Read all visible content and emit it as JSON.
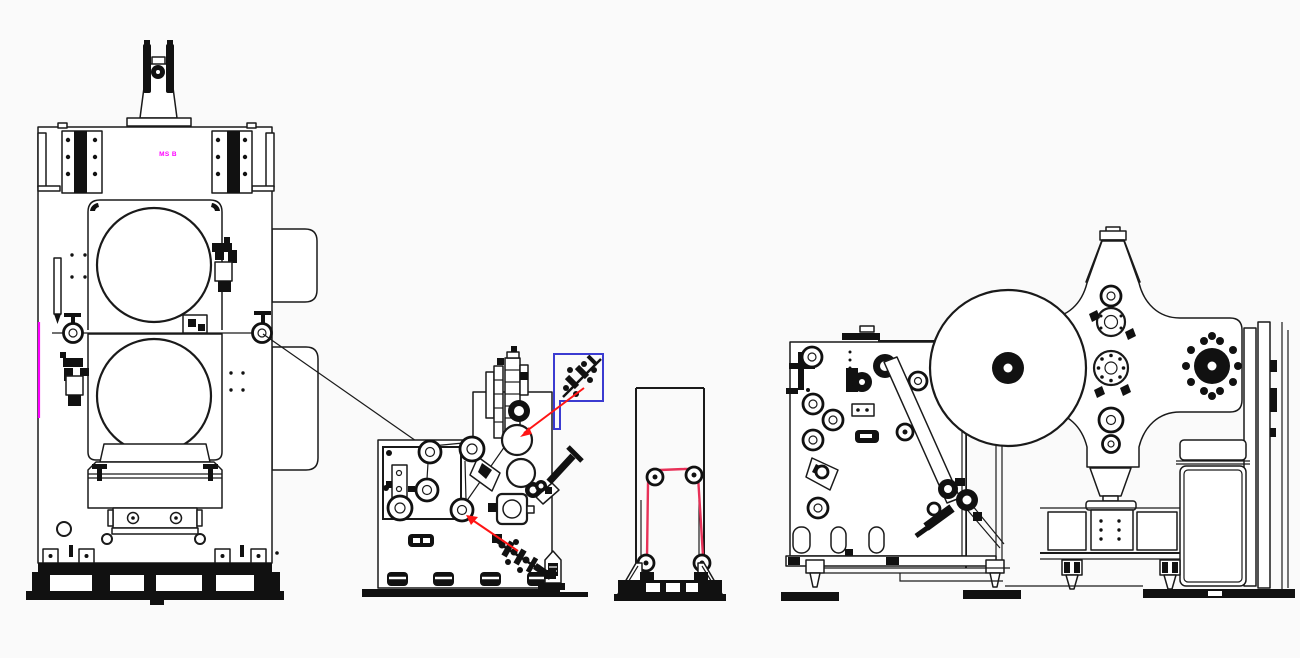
{
  "page": {
    "width": 1300,
    "height": 658
  },
  "colors": {
    "background": "#fafafa",
    "line": "#1a1a1a",
    "accent_magenta": "#ff00ff",
    "highlight_blue": "#3b3bd1",
    "pointer_red": "#ff1414",
    "web_red": "#e83158"
  },
  "drawing": {
    "type": "engineering line drawing",
    "label": "MS B",
    "machines": [
      {
        "id": "calender-press",
        "name": "two-roll calender press"
      },
      {
        "id": "process-roller-unit",
        "name": "roller process unit"
      },
      {
        "id": "web-guide-stand",
        "name": "web guide stand"
      },
      {
        "id": "turret-winder",
        "name": "turret winder"
      }
    ],
    "annotations": {
      "highlight_box": {
        "shape": "stepped rectangle",
        "color_key": "highlight_blue"
      },
      "pointer_line_count": 2,
      "web_path_color_key": "web_red",
      "edge_mark_color_key": "accent_magenta"
    }
  }
}
